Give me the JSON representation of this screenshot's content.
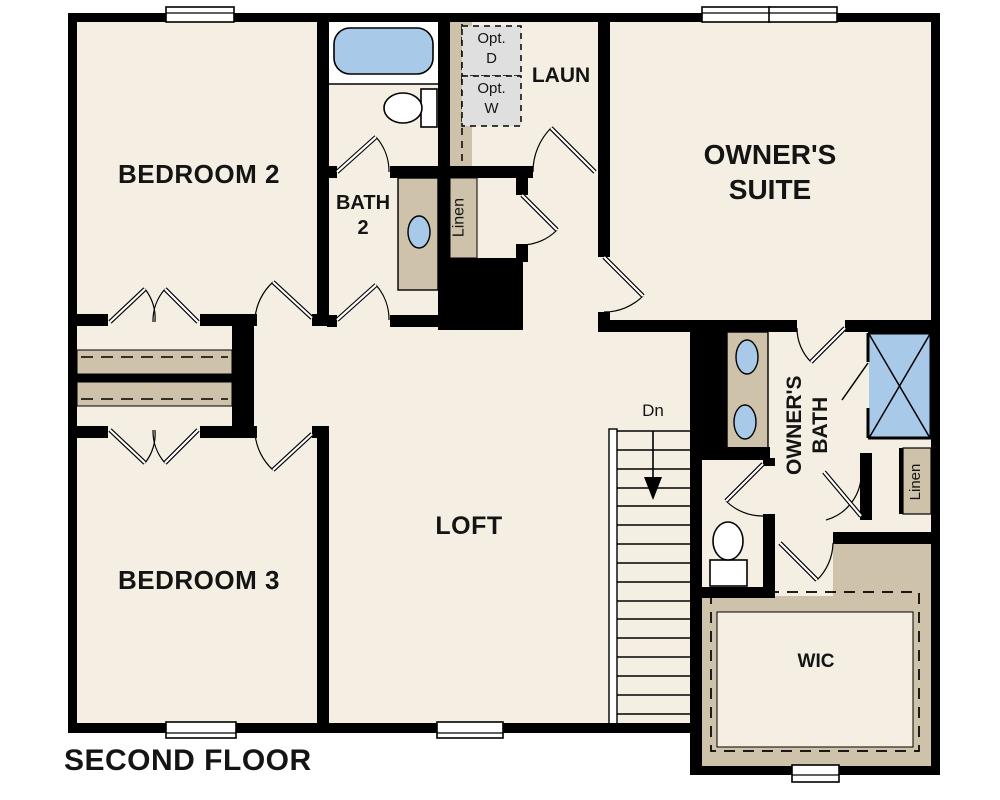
{
  "plan_title": "SECOND FLOOR",
  "rooms": {
    "bedroom2": {
      "label": "BEDROOM 2"
    },
    "bath2": {
      "line1": "BATH",
      "line2": "2"
    },
    "laundry": {
      "label": "LAUN"
    },
    "owners_suite": {
      "line1": "OWNER'S",
      "line2": "SUITE"
    },
    "loft": {
      "label": "LOFT"
    },
    "bedroom3": {
      "label": "BEDROOM 3"
    },
    "owners_bath": {
      "line1": "OWNER'S",
      "line2": "BATH"
    },
    "wic": {
      "label": "WIC"
    },
    "linen_hall": {
      "label": "Linen"
    },
    "linen_bath": {
      "label": "Linen"
    }
  },
  "annotations": {
    "stairs_down": "Dn",
    "opt_dryer": {
      "line1": "Opt.",
      "line2": "D"
    },
    "opt_washer": {
      "line1": "Opt.",
      "line2": "W"
    }
  },
  "theme": {
    "floor": "#f5eee2",
    "cabinet": "#cec2aa",
    "fixture": "#a9c9e9",
    "appliance": "#dfdfdf",
    "wall": "#000000",
    "paper": "#ffffff"
  }
}
